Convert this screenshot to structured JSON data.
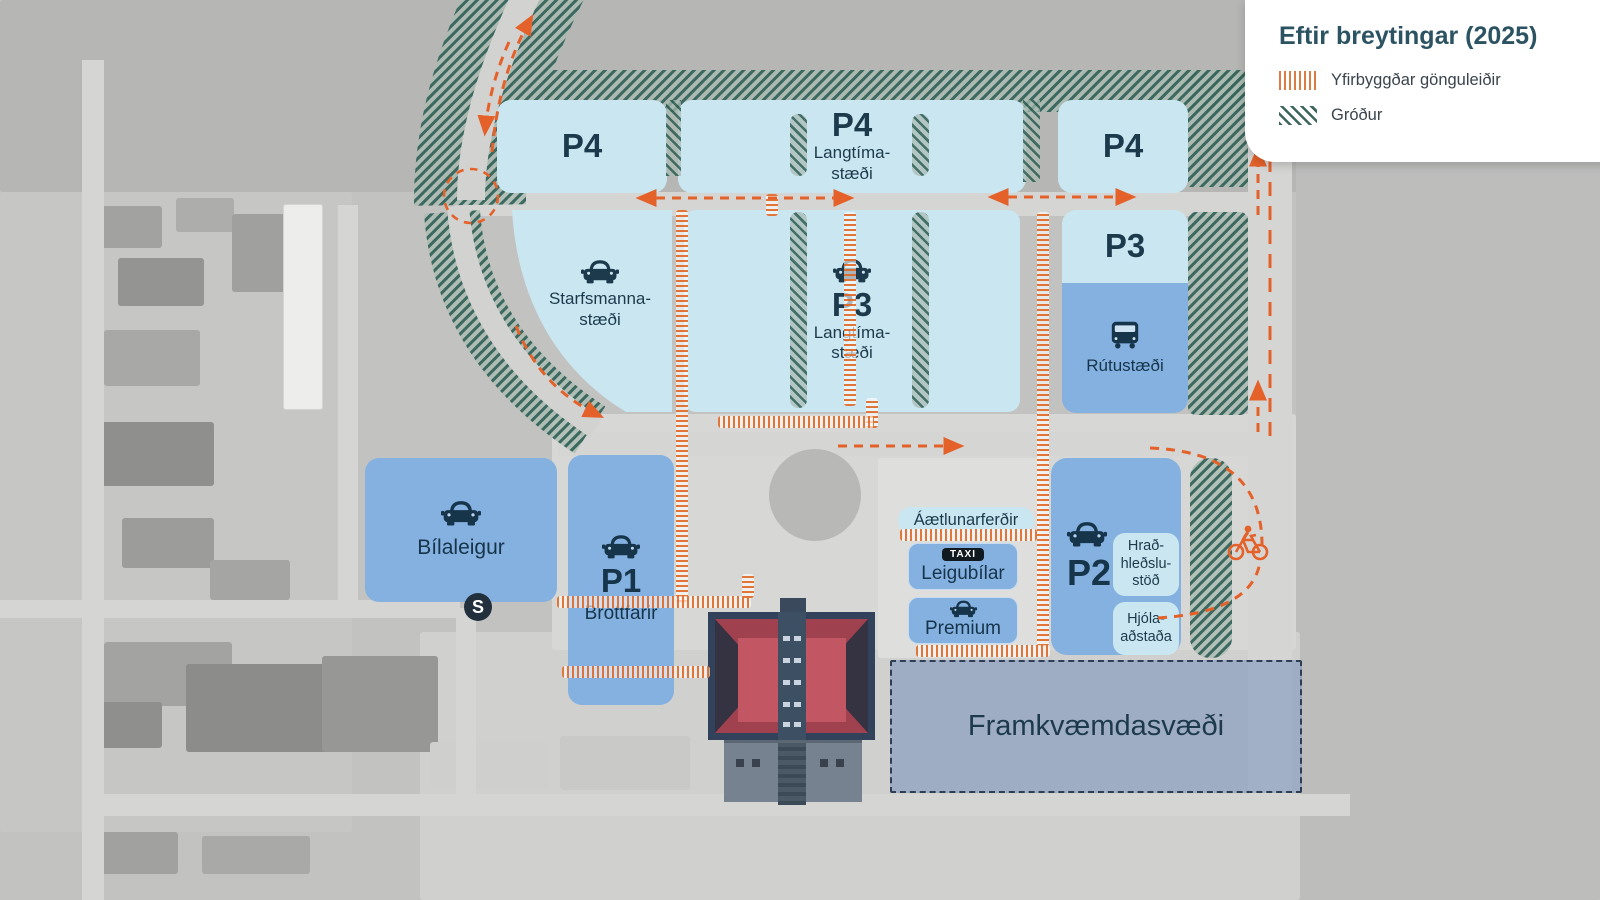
{
  "legend": {
    "title": "Eftir breytingar (2025)",
    "items": [
      {
        "label": "Yfirbyggðar gönguleiðir",
        "swatch": "orange-vertical-stripes"
      },
      {
        "label": "Gróður",
        "swatch": "green-diagonal-stripes"
      }
    ]
  },
  "zones": {
    "p4_left": {
      "label": "P4"
    },
    "p4_center": {
      "label": "P4",
      "sub1": "Langtíma-",
      "sub2": "stæði"
    },
    "p4_right": {
      "label": "P4"
    },
    "p3_right": {
      "label": "P3"
    },
    "rutustaedi": {
      "label": "Rútustæði"
    },
    "starfsmanna": {
      "sub1": "Starfsmanna-",
      "sub2": "stæði"
    },
    "p3_center": {
      "label": "P3",
      "sub1": "Langtíma-",
      "sub2": "stæði"
    },
    "bilaleigur": {
      "label": "Bílaleigur"
    },
    "p1": {
      "label": "P1",
      "sub": "Brottfarir"
    },
    "aetlunarferdir": {
      "label": "Áætlunarferðir"
    },
    "leigubilar": {
      "label": "Leigubílar",
      "badge": "TAXI"
    },
    "premium": {
      "label": "Premium"
    },
    "p2": {
      "label": "P2"
    },
    "hradhledslustod": {
      "line1": "Hrað-",
      "line2": "hleðslu-",
      "line3": "stöð"
    },
    "hjolaadstada": {
      "line1": "Hjóla-",
      "line2": "aðstaða"
    },
    "framkvaemdasvaedi": {
      "label": "Framkvæmdasvæði"
    },
    "shuttle_stop": {
      "label": "S"
    }
  },
  "icons": {
    "car": "car-icon",
    "bus": "bus-icon",
    "bicycle": "bicycle-icon",
    "taxi": "taxi-badge",
    "shuttle": "s-badge"
  },
  "colors": {
    "accent_orange": "#e4662a",
    "parking_light_blue": "#c9e6f1",
    "parking_medium_blue": "#84b1e0",
    "vegetation_green": "#2f6055",
    "label_navy": "#1d3a4d",
    "construction_blue": "#6888b8",
    "legend_title": "#2c5362"
  }
}
